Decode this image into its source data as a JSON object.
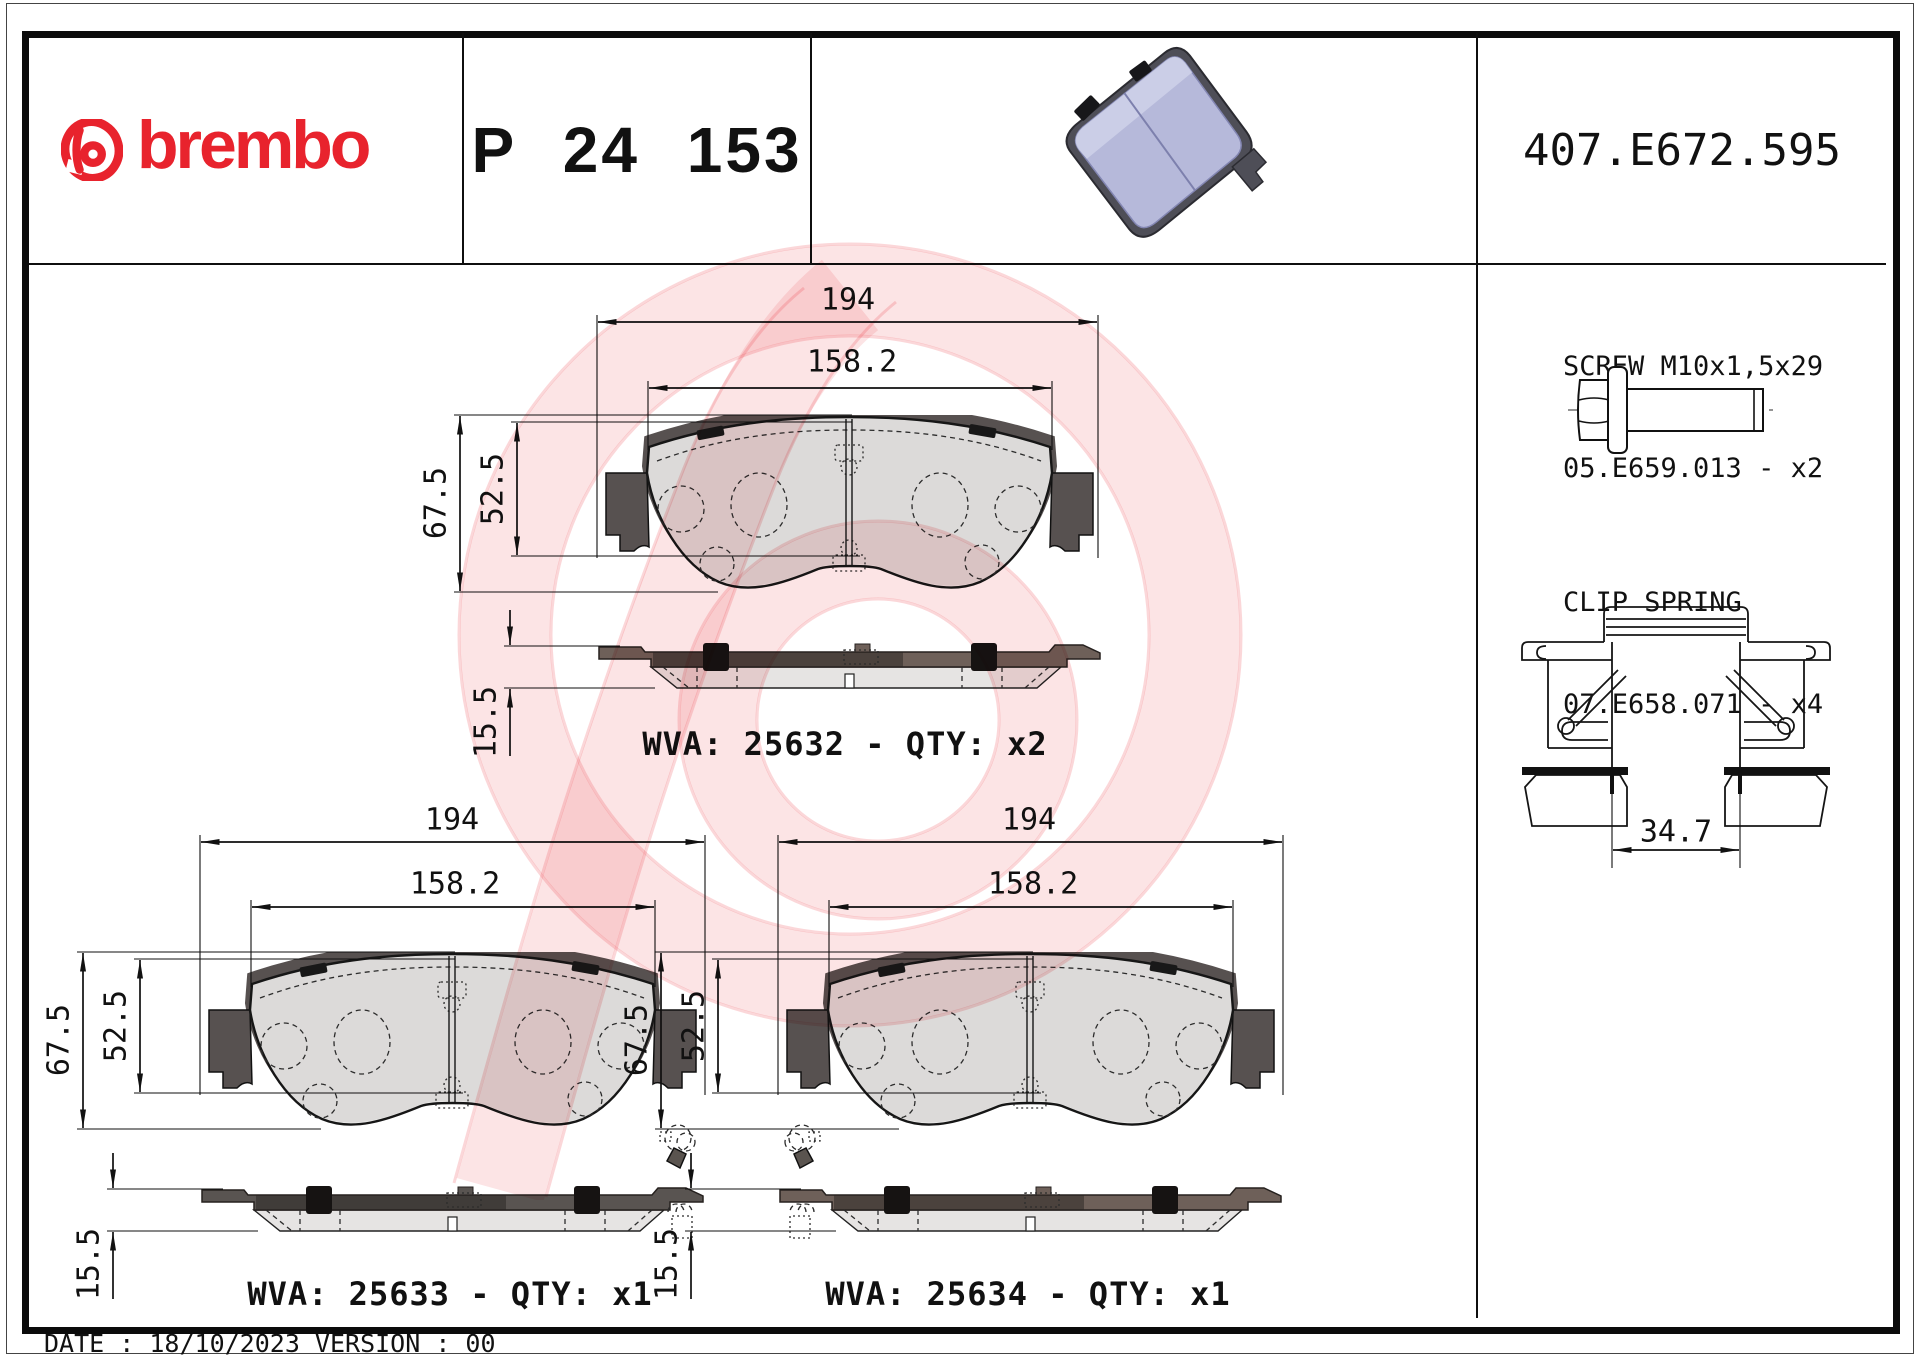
{
  "header": {
    "brand_wordmark": "brembo",
    "part_number": "P 24 153",
    "reference_number": "407.E672.595"
  },
  "hardware": {
    "screw": {
      "title": "SCREW M10x1,5x29",
      "code_qty": "05.E659.013 - x2"
    },
    "clip_spring": {
      "title": "CLIP SPRING",
      "code_qty": "07.E658.071 - x4",
      "width_dim": "34.7"
    }
  },
  "pads": [
    {
      "name": "pad-top",
      "wva_label": "WVA: 25632 - QTY: x2",
      "dims": {
        "total_width": "194",
        "friction_width": "158.2",
        "total_height": "67.5",
        "friction_height": "52.5",
        "thickness": "15.5"
      }
    },
    {
      "name": "pad-bottom-left",
      "wva_label": "WVA: 25633 - QTY: x1",
      "dims": {
        "total_width": "194",
        "friction_width": "158.2",
        "total_height": "67.5",
        "friction_height": "52.5",
        "thickness": "15.5"
      }
    },
    {
      "name": "pad-bottom-right",
      "wva_label": "WVA: 25634 - QTY: x1",
      "dims": {
        "total_width": "194",
        "friction_width": "158.2",
        "total_height": "67.5",
        "friction_height": "52.5",
        "thickness": "15.5"
      }
    }
  ],
  "footer": {
    "date_version": "DATE : 18/10/2023 VERSION : 00"
  },
  "icons": {
    "brand_mark": "brembo-circle-b-icon"
  },
  "colors": {
    "brand_red": "#e8232d",
    "ink": "#111111",
    "pad_3d_face": "#b6b9da",
    "backing_brown": "#6e6059",
    "backing_gray": "#595451",
    "friction_gray": "#e5e4e3",
    "watermark_pink": "#fbdfdf"
  }
}
